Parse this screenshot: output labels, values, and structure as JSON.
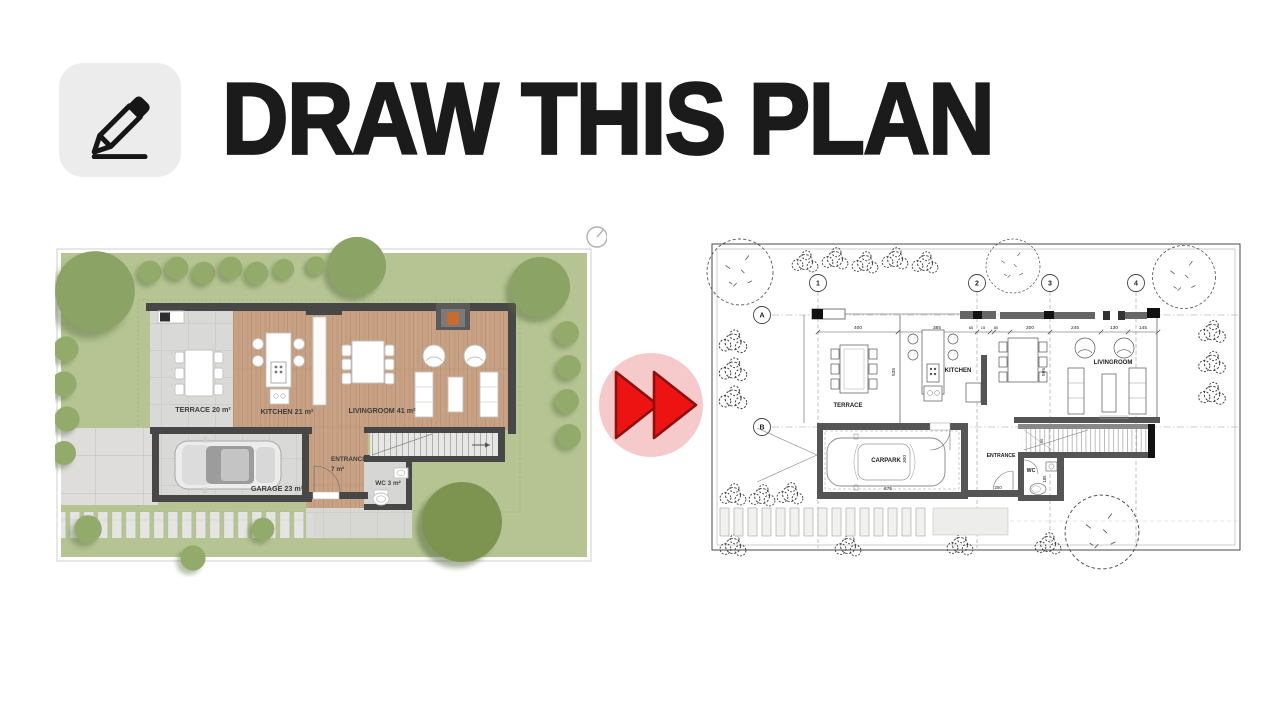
{
  "header": {
    "title": "DRAW THIS PLAN"
  },
  "source_plan": {
    "terrace": "TERRACE 20 m²",
    "kitchen": "KITCHEN 21 m²",
    "livingroom": "LIVINGROOM 41 m²",
    "entrance": "ENTRANCE",
    "entrance_area": "7 m²",
    "garage": "GARAGE 23 m²",
    "wc": "WC 3 m²"
  },
  "cad_plan": {
    "grid_columns": [
      "1",
      "2",
      "3",
      "4"
    ],
    "grid_rows": [
      "A",
      "B"
    ],
    "rooms": {
      "terrace": "TERRACE",
      "kitchen": "KITCHEN",
      "livingroom": "LIVINGROOM",
      "carpark": "CARPARK",
      "entrance": "ENTRANCE",
      "wc": "WC"
    },
    "dims_top": [
      "400",
      "385",
      "65",
      "15",
      "80",
      "200",
      "245",
      "130",
      "145"
    ],
    "dim_kitchen_depth": "535",
    "dim_livingroom_depth": "595",
    "dim_carpark_depth": "300",
    "dim_carpark_width": "675",
    "dim_entrance": "200",
    "dim_wc": "185",
    "dim_stair": "90"
  },
  "colors": {
    "accent_red": "#ee1313",
    "accent_pink": "#f6caca",
    "lawn_green": "#b5c492",
    "tree_green": "#8ba364",
    "wood_floor": "#c9a285",
    "stone_gray": "#d9d9d7",
    "wall_dark": "#474747",
    "ink": "#1b1b1b"
  }
}
